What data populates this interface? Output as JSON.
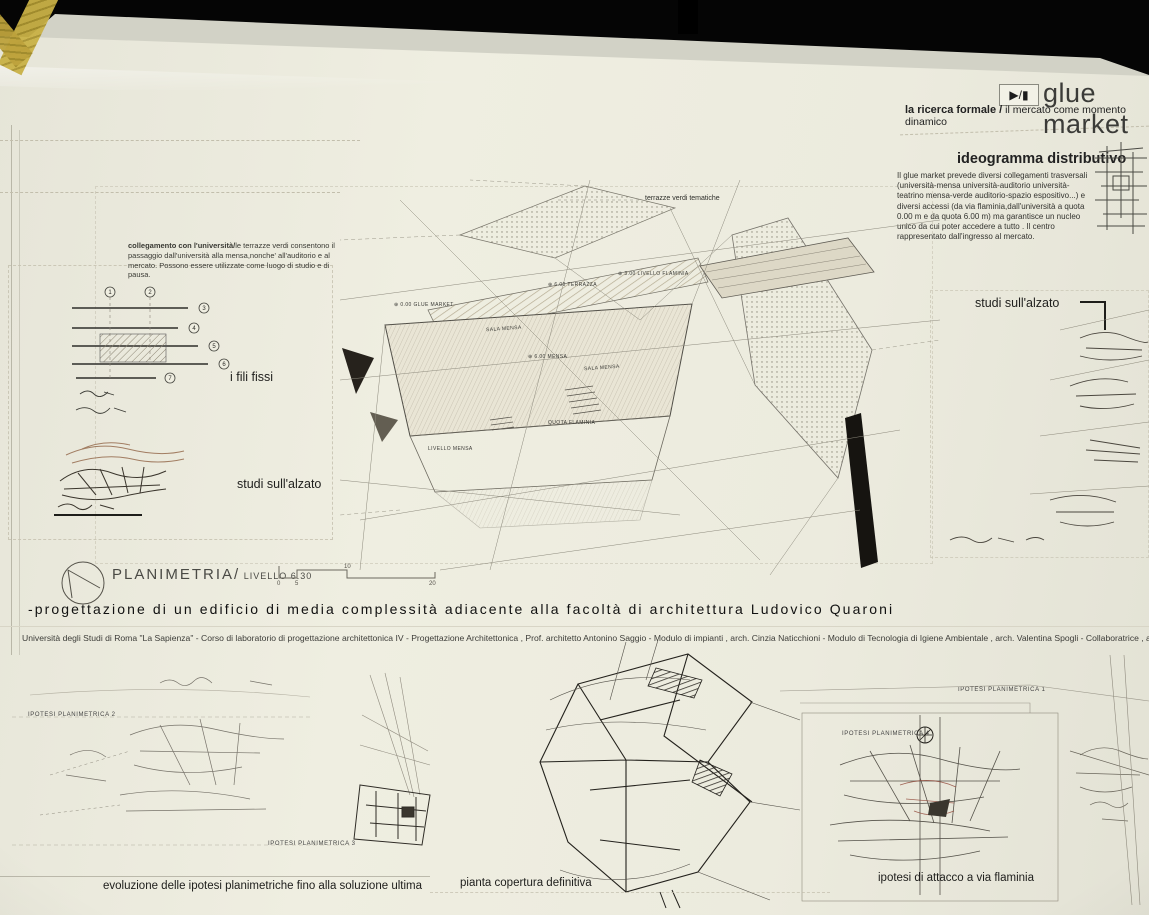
{
  "poster": {
    "header": {
      "play_icon": "▶/▮",
      "title": "glue market",
      "subtitle_bold": "la ricerca formale /",
      "subtitle_rest": " il mercato come momento dinamico"
    },
    "ideogramma": {
      "heading": "ideogramma distributivo",
      "body": "Il glue market  prevede diversi collegamenti trasversali (università-mensa  università-auditorio università-teatrino  mensa-verde  auditorio-spazio espositivo...) e diversi accessi (da via flaminia,dall'università a quota 0.00 m e da quota 6.00 m) ma garantisce un nucleo unico da cui poter accedere a tutto . Il centro rappresentato dall'ingresso al mercato."
    },
    "left_note": {
      "bold": "collegamento con l'università/",
      "rest": "le terrazze verdi consentono il passaggio dall'università alla mensa,nonche' all'auditorio e al mercato. Possono essere utilizzate come luogo di studio e di pausa."
    },
    "labels": {
      "fili_fissi": "i fili fissi",
      "studi_alzato_left": "studi sull'alzato",
      "studi_alzato_right": "studi  sull'alzato",
      "terrazze_verdi": "terrazze verdi tematiche"
    },
    "plan_annotations": [
      "⊕ 3.00  LIVELLO FLAMINIA",
      "⊕ 6.00  TERRAZZA",
      "⊕ 0.00  GLUE MARKET",
      "SALA MENSA",
      "⊕ 6.00  MENSA",
      "SALA MENSA",
      "QUOTA FLAMINIA",
      "LIVELLO MENSA"
    ],
    "fili_numbers": [
      "1",
      "2",
      "3",
      "4",
      "5",
      "6",
      "7"
    ],
    "planimetria": {
      "title": "PLANIMETRIA/",
      "level": " LIVELLO 6.30",
      "scale_ticks": [
        "0",
        "5",
        "10",
        "20"
      ]
    },
    "title_band": {
      "main": "-progettazione di un edificio di media complessità adiacente alla facoltà di architettura Ludovico Quaroni",
      "credits": "Università degli Studi di Roma \"La Sapienza\"  -  Corso di laboratorio di progettazione architettonica IV   -  Progettazione Architettonica , Prof. architetto Antonino Saggio  -  Modulo di impianti ,  arch. Cinzia Naticchioni  -  Modulo di Tecnologia di Igiene Ambientale , arch. Valentina Spogli  -  Collaboratrice , arch. Angelini Rosetta -   Stud.essa Lo"
    },
    "bottom": {
      "ipotesi_1": "IPOTESI PLANIMETRICA 1",
      "ipotesi_2": "IPOTESI PLANIMETRICA 2",
      "ipotesi_3": "IPOTESI PLANIMETRICA 3",
      "ipotesi_4": "IPOTESI PLANIMETRICA 4",
      "caption_left": "evoluzione delle ipotesi planimetriche fino alla soluzione ultima",
      "caption_center": "pianta copertura definitiva",
      "caption_right": "ipotesi di attacco a via flaminia"
    },
    "colors": {
      "backdrop": "#050505",
      "paper": "#ecebde",
      "tape": "#c3aa3e",
      "ink": "#2a2a2a",
      "sketch_gray": "#777770",
      "hatch_beige": "#cfc5ae",
      "accent_red": "#9a4a34"
    }
  }
}
